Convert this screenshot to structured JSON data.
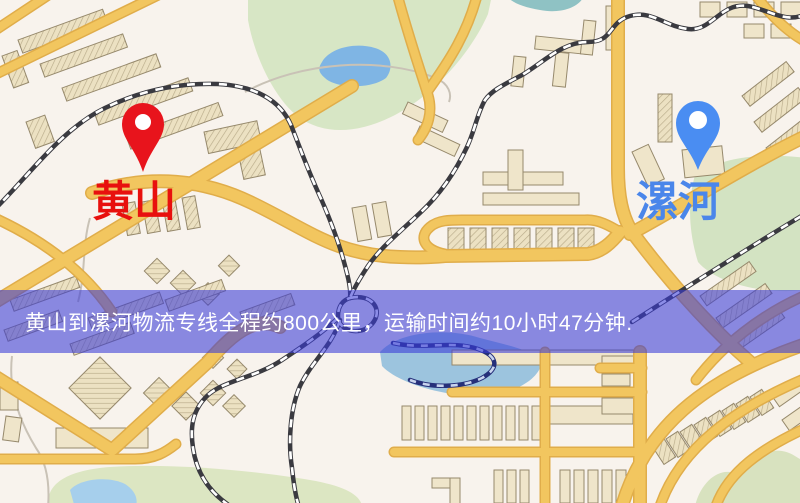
{
  "banner": {
    "text": "黄山到漯河物流专线全程约800公里，运输时间约10小时47分钟.",
    "background_color": "#383ad8",
    "background_opacity": 0.58,
    "text_color": "#ffffff"
  },
  "markers": {
    "origin": {
      "label": "黄山",
      "label_color": "#e8100e",
      "pin_color": "#e8141c",
      "pin_style": "map-pin"
    },
    "destination": {
      "label": "漯河",
      "label_color": "#4a86ea",
      "pin_color": "#4a8df2",
      "pin_style": "map-pin"
    }
  },
  "route": {
    "origin": "黄山",
    "destination": "漯河",
    "service": "物流专线",
    "distance_text": "约800公里",
    "duration_text": "约10小时47分钟"
  },
  "map_palette": {
    "background": "#f8f3ed",
    "road": "#f2c65f",
    "road_casing": "#e0ad4a",
    "building": "#efe5ca",
    "building_outline": "#96896c",
    "park_green": "#d7e6c5",
    "water_blue": "#7fb5e4",
    "railway_dark": "#3a3a40",
    "railway_light": "#ffffff"
  }
}
